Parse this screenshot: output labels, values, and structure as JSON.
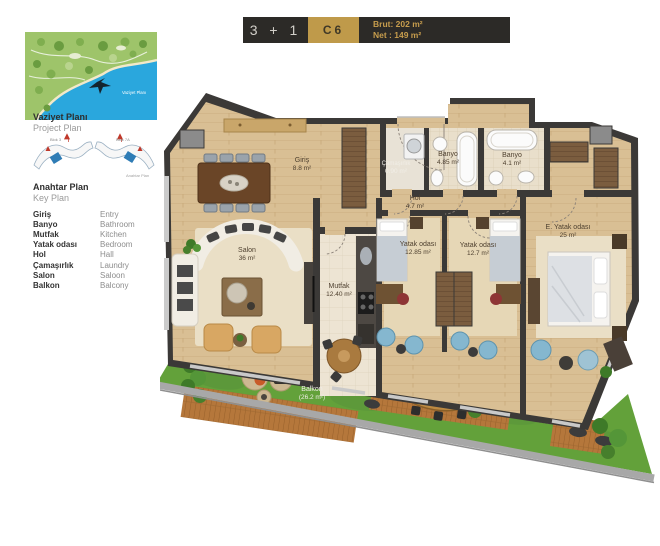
{
  "header": {
    "type_label": "3 + 1",
    "unit_label": "C6",
    "brut": "Brut: 202 m²",
    "net": "Net : 149 m²"
  },
  "sidebar": {
    "project_plan_title_tr": "Vaziyet Planı",
    "project_plan_title_en": "Project Plan",
    "map_inline_label": "Vaziyet Planı",
    "key_plan_title_tr": "Anahtar Plan",
    "key_plan_title_en": "Key Plan",
    "key_plan_caption": "Anahtar Plan",
    "block_left_label": "Blok 3",
    "block_right_label": "Blok 7A",
    "legend": {
      "items": [
        {
          "tr": "Giriş",
          "en": "Entry"
        },
        {
          "tr": "Banyo",
          "en": "Bathroom"
        },
        {
          "tr": "Mutfak",
          "en": "Kitchen"
        },
        {
          "tr": "Yatak odası",
          "en": "Bedroom"
        },
        {
          "tr": "Hol",
          "en": "Hall"
        },
        {
          "tr": "Çamaşırlık",
          "en": "Laundry"
        },
        {
          "tr": "Salon",
          "en": "Saloon"
        },
        {
          "tr": "Balkon",
          "en": "Balcony"
        }
      ]
    }
  },
  "floor_plan": {
    "rooms": [
      {
        "id": "giris",
        "name": "Giriş",
        "area": "8.8 m²"
      },
      {
        "id": "camasirlik",
        "name": "Çamaşırlık",
        "area": "0.90 m²"
      },
      {
        "id": "banyo1",
        "name": "Banyo",
        "area": "4.85 m²"
      },
      {
        "id": "banyo2",
        "name": "Banyo",
        "area": "4.1 m²"
      },
      {
        "id": "hol",
        "name": "Hol",
        "area": "4.7 m²"
      },
      {
        "id": "salon",
        "name": "Salon",
        "area": "36 m²"
      },
      {
        "id": "mutfak",
        "name": "Mutfak",
        "area": "12.40 m²"
      },
      {
        "id": "yatak1",
        "name": "Yatak odası",
        "area": "12.85 m²"
      },
      {
        "id": "yatak2",
        "name": "Yatak odası",
        "area": "12.7 m²"
      },
      {
        "id": "e_yatak",
        "name": "E. Yatak odası",
        "area": "25 m²"
      },
      {
        "id": "balkon",
        "name": "Balkon",
        "area": "(26.2 m²)"
      }
    ]
  },
  "colors": {
    "accent_gold": "#bf9a4a",
    "header_dark": "#2c2a27",
    "wall": "#3b3937",
    "wood_floor": "#d9bf94",
    "grass": "#63a13a",
    "unit_highlight_blue": "#2f7cb5",
    "sea_blue": "#2aa7dd"
  }
}
